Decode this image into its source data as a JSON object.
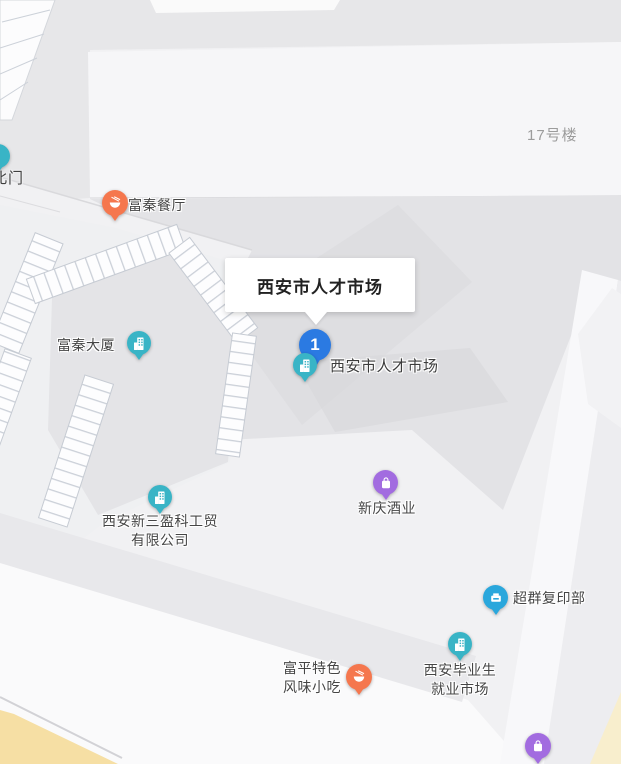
{
  "map": {
    "area_labels": {
      "building_17": "17号楼",
      "north_gate": "北门"
    },
    "info_window": {
      "title": "西安市人才市场"
    },
    "selected_marker": {
      "number": "1",
      "label": "西安市人才市场"
    },
    "pois": [
      {
        "name": "富秦餐厅",
        "category": "restaurant"
      },
      {
        "name": "富秦大厦",
        "category": "office-building"
      },
      {
        "line1": "西安新三盈科工贸",
        "line2": "有限公司",
        "category": "office-building"
      },
      {
        "name": "新庆酒业",
        "category": "shopping"
      },
      {
        "name": "超群复印部",
        "category": "print-shop"
      },
      {
        "line1": "富平特色",
        "line2": "风味小吃",
        "category": "restaurant"
      },
      {
        "line1": "西安毕业生",
        "line2": "就业市场",
        "category": "office-building"
      },
      {
        "category": "shopping"
      }
    ],
    "colors": {
      "poi_building": "#39b4c6",
      "poi_restaurant": "#f5774e",
      "poi_shopping": "#a26ce0",
      "poi_print": "#2aa7dc",
      "selected_pin": "#2b7ae2",
      "area_label_text": "#9c9c9c",
      "poi_label_text": "#454545",
      "map_background": "#f1f1f3"
    }
  }
}
